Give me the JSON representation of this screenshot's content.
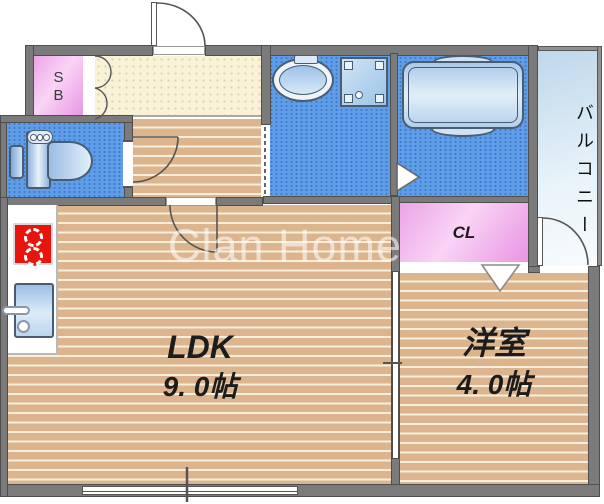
{
  "watermark": {
    "text": "Clan Home"
  },
  "rooms": {
    "ldk": {
      "label": "LDK",
      "area": "9. 0帖"
    },
    "western": {
      "label": "洋室",
      "area": "4. 0帖"
    },
    "balcony": {
      "label": "バルコニー"
    },
    "closet": {
      "label": "CL"
    },
    "shoe_box": {
      "label": "SB"
    }
  },
  "fixture_icons": [
    "entrance-swing-door-icon",
    "shoe-box-folding-door-icon",
    "toilet-icon",
    "washbasin-icon",
    "washing-machine-pan-icon",
    "bathtub-icon",
    "gas-stove-icon",
    "kitchen-sink-icon",
    "closet-folding-door-icon",
    "sliding-partition-icon",
    "sliding-window-icon",
    "balcony-swing-door-icon"
  ],
  "colors": {
    "wall": "#7b7b7b",
    "wood_floor": "#dcb48e",
    "wet_area_floor": "#5f9ee7",
    "entrance_tile": "#f9f2d8",
    "storage_pink": "#eca4e6",
    "balcony_blue": "#d8e8f4",
    "stove_red": "#e8150e",
    "fixture_blue": "#9dbfe6",
    "watermark_white": "rgba(255,255,255,0.55)"
  }
}
